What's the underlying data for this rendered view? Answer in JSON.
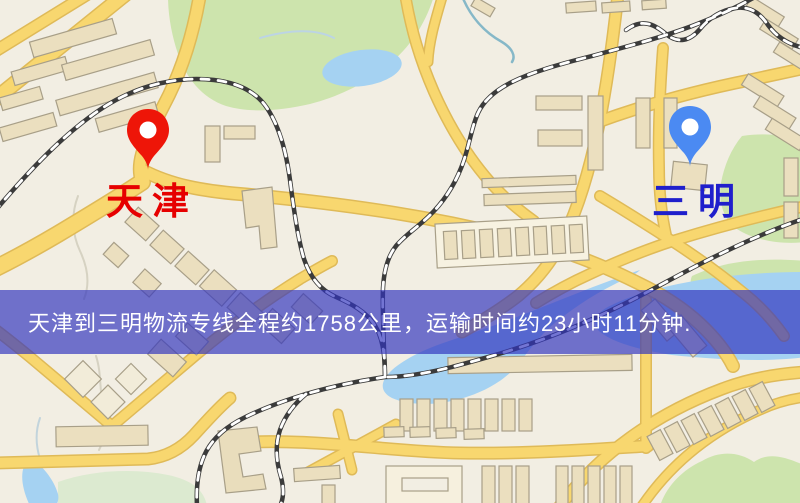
{
  "markers": {
    "origin": {
      "label": "天津",
      "pin_color": "#ee1508",
      "label_color": "#e60000",
      "pin_style": "red-map-pin"
    },
    "destination": {
      "label": "三明",
      "pin_color": "#4b8af2",
      "label_color": "#1f1fcc",
      "pin_style": "blue-map-pin"
    }
  },
  "banner": {
    "text": "天津到三明物流专线全程约1758公里，运输时间约23小时11分钟.",
    "background_color": "rgba(48,52,190,0.68)",
    "text_color": "#ffffff",
    "route": {
      "origin": "天津",
      "destination": "三明",
      "distance_km": 1758,
      "duration_hours": 23,
      "duration_minutes": 11
    }
  },
  "map_palette": {
    "background": "#f2eee3",
    "road_fill": "#f8d76f",
    "road_casing": "#dfba58",
    "water": "#a5d2f2",
    "green_area": "#cde4ad",
    "building_fill": "#ebdfbf",
    "building_stroke": "#a89f88",
    "railway_dark": "#3b3b3b",
    "railway_light": "#ffffff"
  }
}
